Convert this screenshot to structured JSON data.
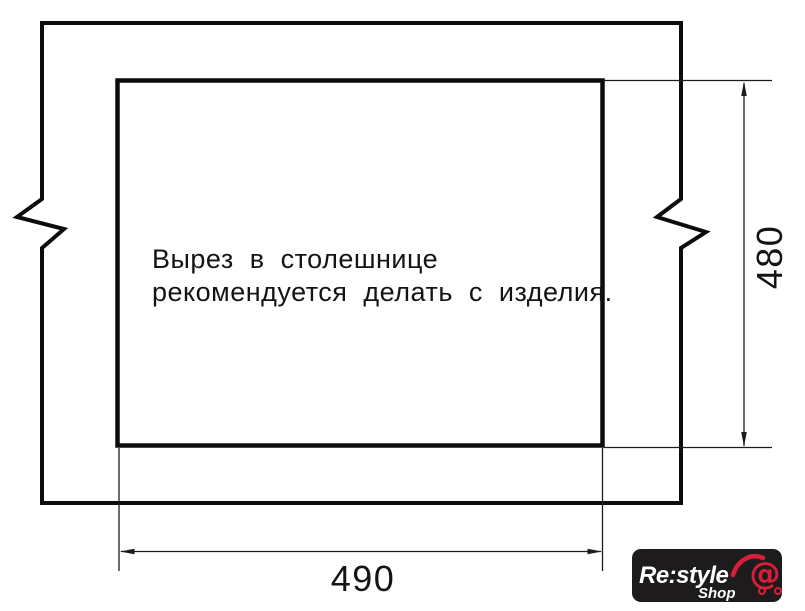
{
  "drawing": {
    "note_line1": "Вырез в столешнице",
    "note_line2": "рекомендуется делать с изделия.",
    "width_dim": "490",
    "height_dim": "480",
    "line_color": "#0c0c0c"
  },
  "logo": {
    "brand": "Re:style",
    "sub": "Shop",
    "at_symbol": "@",
    "bg_color": "#1d1b1c",
    "text_color": "#ffffff",
    "accent_color": "#d91f38"
  }
}
